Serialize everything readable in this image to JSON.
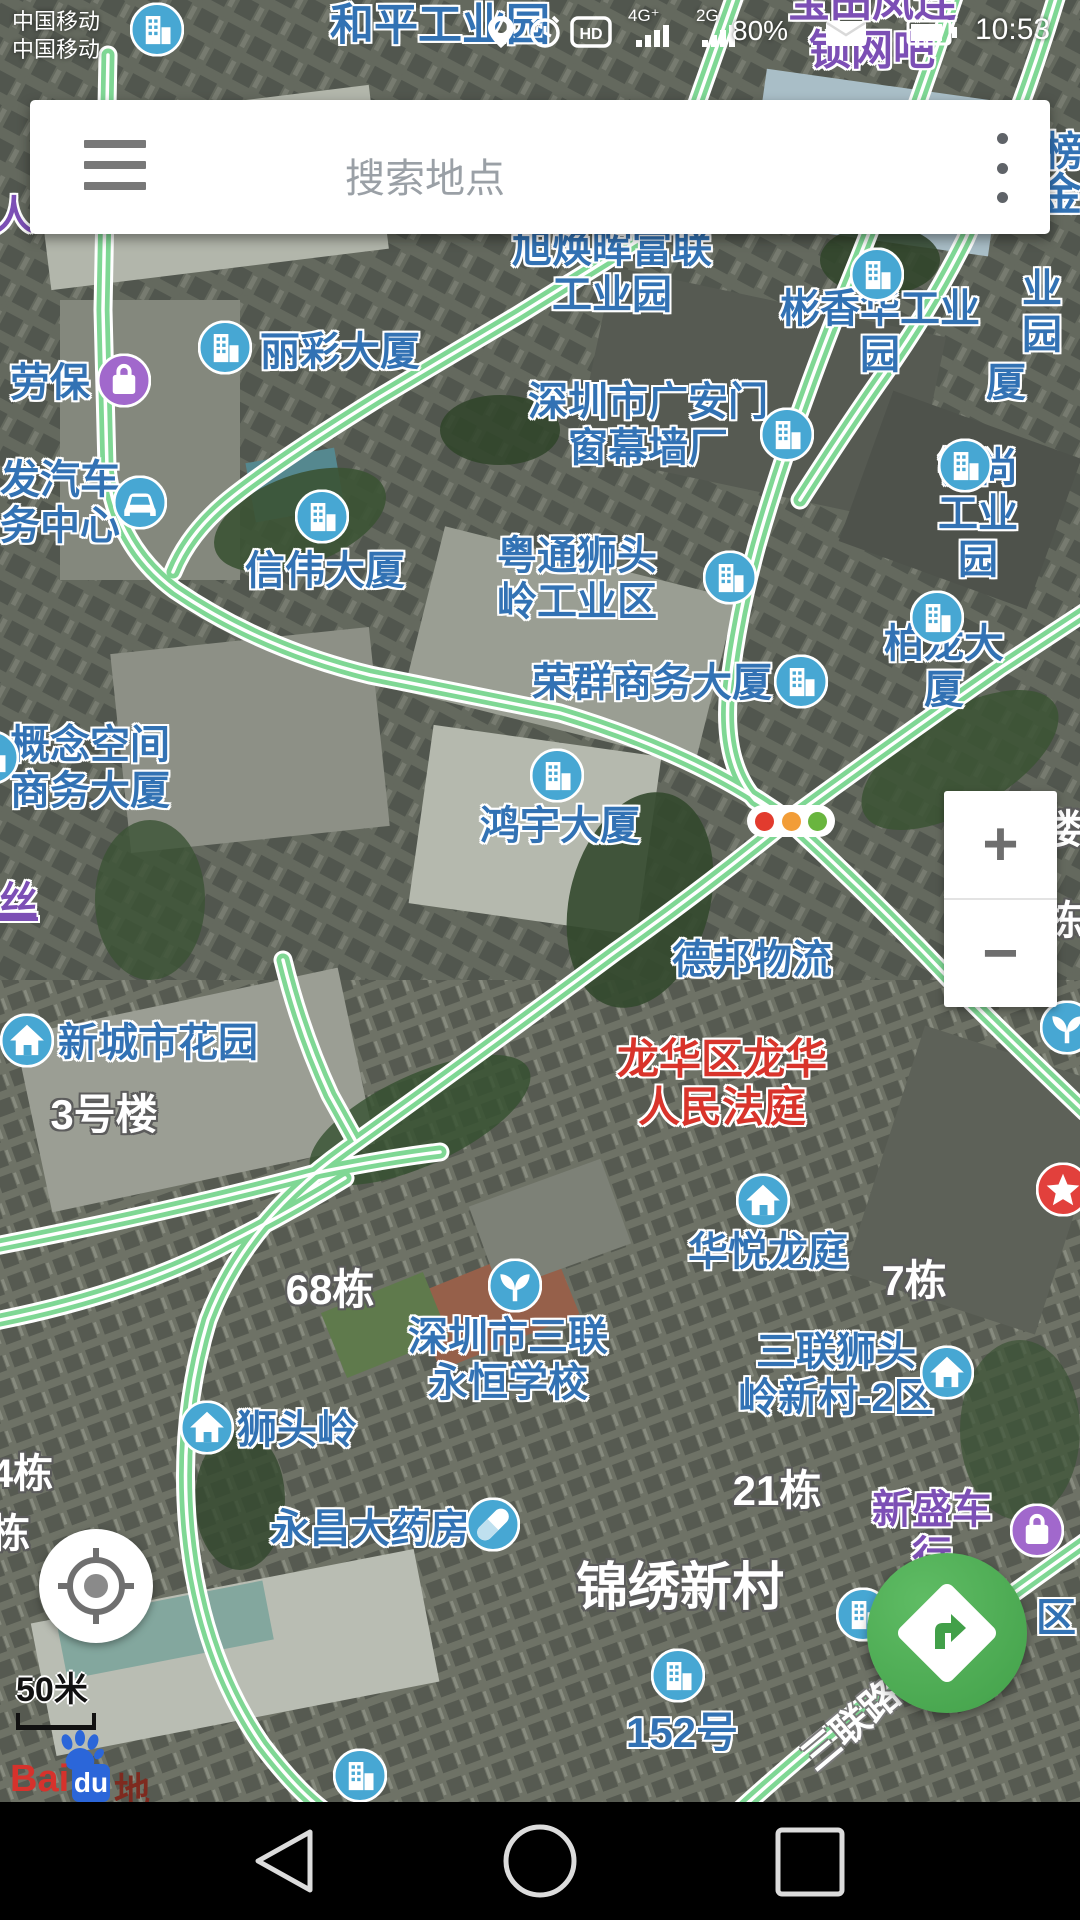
{
  "status_bar": {
    "carrier_line1": "中国移动",
    "carrier_line2": "中国移动",
    "hd_badge": "HD",
    "network_a": "4G⁺",
    "network_b": "2G",
    "battery_percent": "80%",
    "time": "10:53"
  },
  "search_bar": {
    "placeholder": "搜索地点"
  },
  "zoom_controls": {
    "zoom_in": "+",
    "zoom_out": "−"
  },
  "map_scale": {
    "label": "50米"
  },
  "brand": {
    "logo_bai": "Bai",
    "logo_du": "du",
    "logo_suffix": "地图"
  },
  "colors": {
    "label_blue": "#3272b4",
    "label_red": "#d9342b",
    "label_purple": "#7c4fb5",
    "road_green": "#7fd794",
    "poi_icon_blue": "#47a7d3",
    "poi_icon_purple": "#a168cc",
    "route_button_green": "#42a049",
    "star_badge_red": "#e2403c"
  },
  "map": {
    "traffic_light": {
      "x": 791,
      "y": 821
    },
    "poi_labels": [
      {
        "text": "和平工业园",
        "x": 440,
        "y": 26,
        "color": "blue",
        "size": 44
      },
      {
        "text": "宝田凤连锁网吧",
        "x": 872,
        "y": 27,
        "color": "purple",
        "size": 42
      },
      {
        "text": "人",
        "x": 14,
        "y": 216,
        "color": "purple",
        "size": 40
      },
      {
        "text": "榜",
        "x": 1064,
        "y": 152,
        "color": "blue",
        "size": 40
      },
      {
        "text": "金",
        "x": 1060,
        "y": 196,
        "color": "blue",
        "size": 44
      },
      {
        "text": "旭焕晖富联\n工业园",
        "x": 612,
        "y": 272,
        "color": "blue",
        "size": 40
      },
      {
        "text": "丽彩大厦",
        "x": 340,
        "y": 352,
        "color": "blue",
        "size": 40
      },
      {
        "text": "彬香华工业园",
        "x": 880,
        "y": 332,
        "color": "blue",
        "size": 40
      },
      {
        "text": "业园",
        "x": 1042,
        "y": 312,
        "color": "blue",
        "size": 40
      },
      {
        "text": "劳保",
        "x": 50,
        "y": 383,
        "color": "blue",
        "size": 40
      },
      {
        "text": "厦",
        "x": 1006,
        "y": 383,
        "color": "blue",
        "size": 40
      },
      {
        "text": "深圳市广安门\n窗幕墙厂",
        "x": 648,
        "y": 425,
        "color": "blue",
        "size": 40
      },
      {
        "text": "发汽车\n务中心",
        "x": 60,
        "y": 503,
        "color": "blue",
        "size": 40
      },
      {
        "text": "钲尚工业园",
        "x": 978,
        "y": 514,
        "color": "blue",
        "size": 40
      },
      {
        "text": "信伟大厦",
        "x": 325,
        "y": 571,
        "color": "blue",
        "size": 40
      },
      {
        "text": "粤通狮头\n岭工业区",
        "x": 577,
        "y": 579,
        "color": "blue",
        "size": 40
      },
      {
        "text": "柏龙大厦",
        "x": 944,
        "y": 667,
        "color": "blue",
        "size": 40
      },
      {
        "text": "荣群商务大厦",
        "x": 652,
        "y": 683,
        "color": "blue",
        "size": 40
      },
      {
        "text": "概念空间\n商务大厦",
        "x": 90,
        "y": 768,
        "color": "blue",
        "size": 40
      },
      {
        "text": "鸿宇大厦",
        "x": 560,
        "y": 826,
        "color": "blue",
        "size": 40
      },
      {
        "text": "楼",
        "x": 1062,
        "y": 830,
        "color": "white",
        "size": 40
      },
      {
        "text": "丝",
        "x": 18,
        "y": 902,
        "color": "purple",
        "size": 40,
        "underline": true
      },
      {
        "text": "栋",
        "x": 1064,
        "y": 921,
        "color": "white",
        "size": 40
      },
      {
        "text": "德邦物流",
        "x": 752,
        "y": 960,
        "color": "blue",
        "size": 40
      },
      {
        "text": "新城市花园",
        "x": 158,
        "y": 1043,
        "color": "blue",
        "size": 40
      },
      {
        "text": "龙华区龙华\n人民法庭",
        "x": 722,
        "y": 1084,
        "color": "red",
        "size": 42
      },
      {
        "text": "3号楼",
        "x": 104,
        "y": 1115,
        "color": "white",
        "size": 42
      },
      {
        "text": "华悦龙庭",
        "x": 768,
        "y": 1252,
        "color": "blue",
        "size": 40
      },
      {
        "text": "7栋",
        "x": 914,
        "y": 1281,
        "color": "white",
        "size": 42
      },
      {
        "text": "68栋",
        "x": 330,
        "y": 1290,
        "color": "white",
        "size": 42
      },
      {
        "text": "深圳市三联\n永恒学校",
        "x": 508,
        "y": 1360,
        "color": "blue",
        "size": 40
      },
      {
        "text": "三联狮头\n岭新村-2区",
        "x": 836,
        "y": 1375,
        "color": "blue",
        "size": 40
      },
      {
        "text": "狮头岭",
        "x": 297,
        "y": 1430,
        "color": "blue",
        "size": 40
      },
      {
        "text": "4栋",
        "x": 22,
        "y": 1474,
        "color": "white",
        "size": 40
      },
      {
        "text": "21栋",
        "x": 777,
        "y": 1491,
        "color": "white",
        "size": 42
      },
      {
        "text": "永昌大药房",
        "x": 370,
        "y": 1529,
        "color": "blue",
        "size": 40
      },
      {
        "text": "栋",
        "x": 10,
        "y": 1534,
        "color": "white",
        "size": 40
      },
      {
        "text": "新盛车行",
        "x": 932,
        "y": 1533,
        "color": "purple",
        "size": 40
      },
      {
        "text": "锦绣新村",
        "x": 680,
        "y": 1589,
        "color": "white",
        "size": 52
      },
      {
        "text": "区",
        "x": 1056,
        "y": 1618,
        "color": "blue",
        "size": 40
      },
      {
        "text": "152号",
        "x": 682,
        "y": 1733,
        "color": "blue",
        "size": 42
      },
      {
        "text": "三联路",
        "x": 852,
        "y": 1727,
        "color": "road",
        "size": 38,
        "rotate": -40
      }
    ],
    "poi_icons": [
      {
        "type": "building",
        "x": 157,
        "y": 32
      },
      {
        "type": "building",
        "x": 225,
        "y": 350
      },
      {
        "type": "bag",
        "x": 124,
        "y": 383,
        "variant": "purple"
      },
      {
        "type": "building",
        "x": 877,
        "y": 277
      },
      {
        "type": "building",
        "x": 787,
        "y": 437
      },
      {
        "type": "car",
        "x": 140,
        "y": 505
      },
      {
        "type": "building",
        "x": 965,
        "y": 468
      },
      {
        "type": "building",
        "x": 322,
        "y": 519
      },
      {
        "type": "building",
        "x": 730,
        "y": 580
      },
      {
        "type": "building",
        "x": 937,
        "y": 620
      },
      {
        "type": "building",
        "x": 801,
        "y": 684
      },
      {
        "type": "building",
        "x": -8,
        "y": 760
      },
      {
        "type": "building",
        "x": 557,
        "y": 778
      },
      {
        "type": "home",
        "x": 27,
        "y": 1043
      },
      {
        "type": "home",
        "x": 763,
        "y": 1203
      },
      {
        "type": "plant",
        "x": 515,
        "y": 1288
      },
      {
        "type": "home",
        "x": 947,
        "y": 1375
      },
      {
        "type": "home",
        "x": 207,
        "y": 1430
      },
      {
        "type": "pill",
        "x": 493,
        "y": 1527
      },
      {
        "type": "bag",
        "x": 1037,
        "y": 1533,
        "variant": "purple"
      },
      {
        "type": "building",
        "x": 863,
        "y": 1617
      },
      {
        "type": "building",
        "x": 678,
        "y": 1678
      },
      {
        "type": "building",
        "x": 360,
        "y": 1778
      },
      {
        "type": "plant",
        "x": 1067,
        "y": 1030
      },
      {
        "type": "star",
        "x": 1063,
        "y": 1192
      }
    ]
  }
}
